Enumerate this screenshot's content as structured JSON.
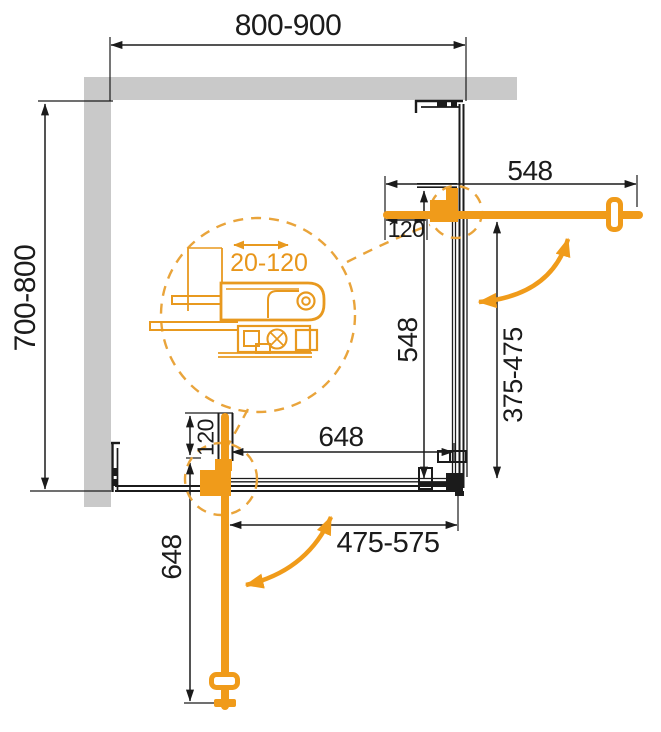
{
  "diagram": {
    "type": "shower-enclosure-corner-entry-plan",
    "labels": {
      "width_range": "800-900",
      "depth_range": "700-800",
      "door_arm_top": "548",
      "fixed_panel_right": "548",
      "entry_right": "375-475",
      "hinge_offset_top": "120",
      "hinge_offset_bottom": "120",
      "fixed_panel_bottom": "648",
      "door_arm_bottom": "648",
      "entry_bottom": "475-575",
      "profile_adjustment": "20-120"
    },
    "colors": {
      "accent_orange": "#F09B1A",
      "dashed_orange": "#E9A43B",
      "detail_orange": "#E8991F",
      "line_black": "#1B1B1B",
      "wall_gray": "#C9C9C9"
    }
  }
}
